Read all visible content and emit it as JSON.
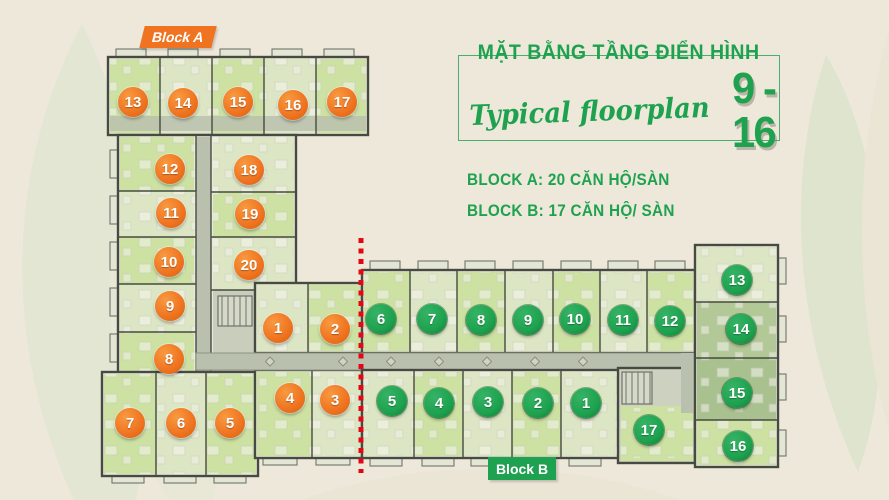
{
  "title": {
    "vietnamese": "MẶT BẰNG TẦNG ĐIỂN HÌNH",
    "english_script": "Typical floorplan",
    "floor_range": "9 - 16"
  },
  "legend": {
    "block_a_info": "BLOCK A: 20 CĂN HỘ/SÀN",
    "block_b_info": "BLOCK B: 17 CĂN HỘ/ SÀN"
  },
  "block_a": {
    "label": "Block A",
    "marker_color": "#ef7320",
    "units": [
      {
        "n": 1,
        "x": 278,
        "y": 328
      },
      {
        "n": 2,
        "x": 335,
        "y": 329
      },
      {
        "n": 3,
        "x": 335,
        "y": 400
      },
      {
        "n": 4,
        "x": 290,
        "y": 398
      },
      {
        "n": 5,
        "x": 230,
        "y": 423
      },
      {
        "n": 6,
        "x": 181,
        "y": 423
      },
      {
        "n": 7,
        "x": 130,
        "y": 423
      },
      {
        "n": 8,
        "x": 169,
        "y": 359
      },
      {
        "n": 9,
        "x": 170,
        "y": 306
      },
      {
        "n": 10,
        "x": 169,
        "y": 262
      },
      {
        "n": 11,
        "x": 171,
        "y": 213
      },
      {
        "n": 12,
        "x": 170,
        "y": 169
      },
      {
        "n": 13,
        "x": 133,
        "y": 102
      },
      {
        "n": 14,
        "x": 183,
        "y": 103
      },
      {
        "n": 15,
        "x": 238,
        "y": 102
      },
      {
        "n": 16,
        "x": 293,
        "y": 105
      },
      {
        "n": 17,
        "x": 342,
        "y": 102
      },
      {
        "n": 18,
        "x": 249,
        "y": 170
      },
      {
        "n": 19,
        "x": 250,
        "y": 214
      },
      {
        "n": 20,
        "x": 249,
        "y": 265
      }
    ]
  },
  "block_b": {
    "label": "Block B",
    "marker_color": "#1ea24f",
    "units": [
      {
        "n": 1,
        "x": 586,
        "y": 403
      },
      {
        "n": 2,
        "x": 538,
        "y": 403
      },
      {
        "n": 3,
        "x": 488,
        "y": 402
      },
      {
        "n": 4,
        "x": 439,
        "y": 403
      },
      {
        "n": 5,
        "x": 392,
        "y": 401
      },
      {
        "n": 6,
        "x": 381,
        "y": 319
      },
      {
        "n": 7,
        "x": 432,
        "y": 319
      },
      {
        "n": 8,
        "x": 481,
        "y": 320
      },
      {
        "n": 9,
        "x": 528,
        "y": 320
      },
      {
        "n": 10,
        "x": 575,
        "y": 319
      },
      {
        "n": 11,
        "x": 623,
        "y": 320
      },
      {
        "n": 12,
        "x": 670,
        "y": 321
      },
      {
        "n": 13,
        "x": 737,
        "y": 280
      },
      {
        "n": 14,
        "x": 741,
        "y": 329
      },
      {
        "n": 15,
        "x": 737,
        "y": 393
      },
      {
        "n": 16,
        "x": 738,
        "y": 446
      },
      {
        "n": 17,
        "x": 649,
        "y": 430
      }
    ]
  },
  "colors": {
    "background": "#eee8da",
    "title_green": "#1fa24f",
    "block_a_orange": "#ef7320",
    "block_b_green": "#1ea24f",
    "red_axis": "#e30613",
    "room_green": "#cde1a3",
    "corridor_gray": "#bac0ae",
    "wall": "#474a41"
  }
}
